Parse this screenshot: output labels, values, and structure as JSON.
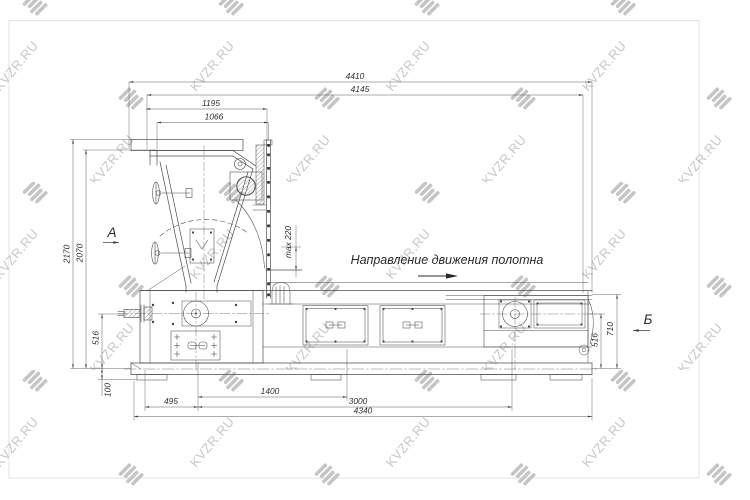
{
  "watermark": {
    "text": "KVZR.RU",
    "color": "#c7c7c7",
    "logo": "kvzr-stripes-logo"
  },
  "page": {
    "background": "#ffffff",
    "border_color": "#e3e3e3"
  },
  "drawing": {
    "type": "engineering-drawing",
    "subject": "belt feeder / conveyor side view",
    "direction_label": "Направление движения полотна",
    "section_a": "А",
    "section_b": "Б",
    "dimensions": {
      "d4410": "4410",
      "d4145": "4145",
      "d1195": "1195",
      "d1066": "1066",
      "d2170": "2170",
      "d2070": "2070",
      "dmax220": "max 220",
      "d516_left": "516",
      "d100": "100",
      "d495": "495",
      "d1400": "1400",
      "d3000": "3000",
      "d4340": "4340",
      "d516_right": "516",
      "d710": "710"
    },
    "colors": {
      "line": "#4d4d4d",
      "dim_line": "#5a5a5a",
      "text": "#2e2e2e"
    }
  }
}
